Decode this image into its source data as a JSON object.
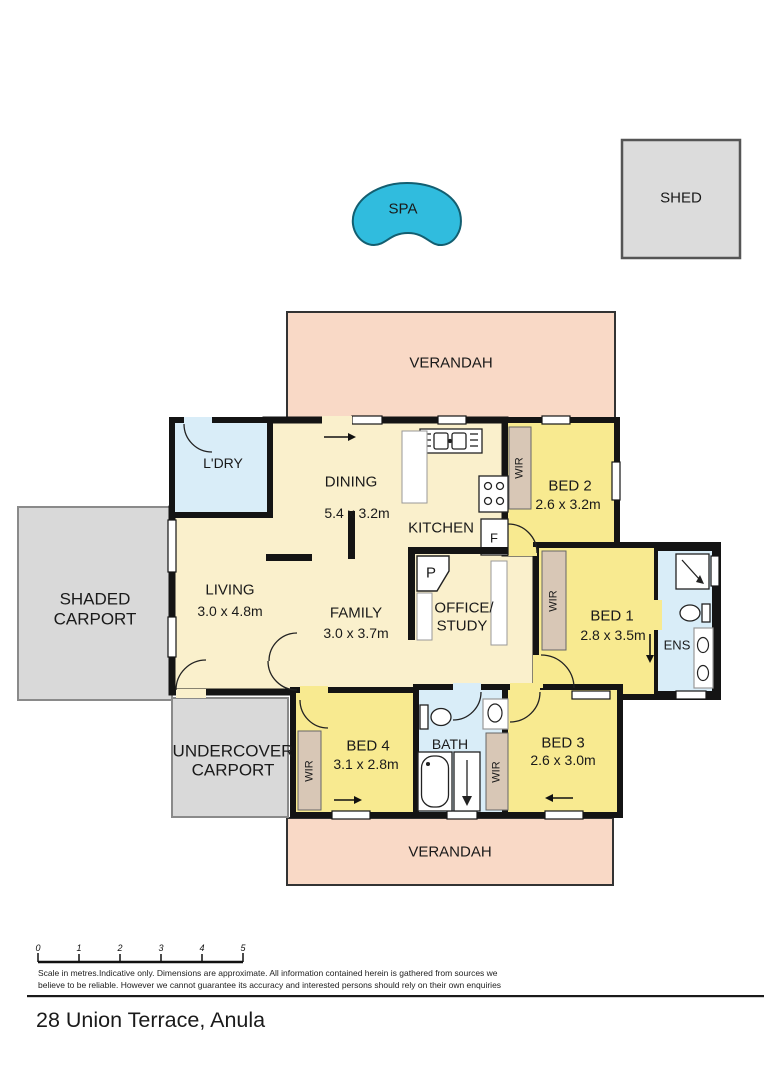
{
  "title": "28 Union Terrace, Anula",
  "outdoor": {
    "spa": "SPA",
    "shed": "SHED",
    "verandah_top": "VERANDAH",
    "verandah_bottom": "VERANDAH",
    "shaded_carport_line1": "SHADED",
    "shaded_carport_line2": "CARPORT",
    "undercover_carport_line1": "UNDERCOVER",
    "undercover_carport_line2": "CARPORT"
  },
  "rooms": {
    "laundry": {
      "name": "L'DRY"
    },
    "dining": {
      "name": "DINING",
      "dims": "5.4 x 3.2m"
    },
    "kitchen": {
      "name": "KITCHEN",
      "fridge": "F",
      "pantry": "P"
    },
    "living": {
      "name": "LIVING",
      "dims": "3.0 x 4.8m"
    },
    "family": {
      "name": "FAMILY",
      "dims": "3.0 x 3.7m"
    },
    "office": {
      "name_line1": "OFFICE/",
      "name_line2": "STUDY"
    },
    "bed1": {
      "name": "BED 1",
      "dims": "2.8 x 3.5m"
    },
    "bed2": {
      "name": "BED 2",
      "dims": "2.6 x 3.2m"
    },
    "bed3": {
      "name": "BED 3",
      "dims": "2.6 x 3.0m"
    },
    "bed4": {
      "name": "BED 4",
      "dims": "3.1 x 2.8m"
    },
    "bath": {
      "name": "BATH"
    },
    "ens": {
      "name": "ENS"
    },
    "wir": "WIR"
  },
  "scale": {
    "ticks": [
      "0",
      "1",
      "2",
      "3",
      "4",
      "5"
    ]
  },
  "footer": {
    "disclaimer_line1": "Scale in metres.Indicative only. Dimensions are approximate. All information contained herein is gathered from sources we",
    "disclaimer_line2": "believe to be reliable. However we cannot guarantee its accuracy and interested persons should rely on their own enquiries"
  },
  "colors": {
    "cream": "#FAF0CC",
    "bedroom_yellow": "#F8EA90",
    "wet_blue": "#D9EDF8",
    "wardrobe_tan": "#D8C7B6",
    "verandah_pink": "#F9D9C6",
    "carport_gray": "#D9D9D9",
    "spa_cyan": "#30BCDE",
    "wall": "#141414"
  }
}
